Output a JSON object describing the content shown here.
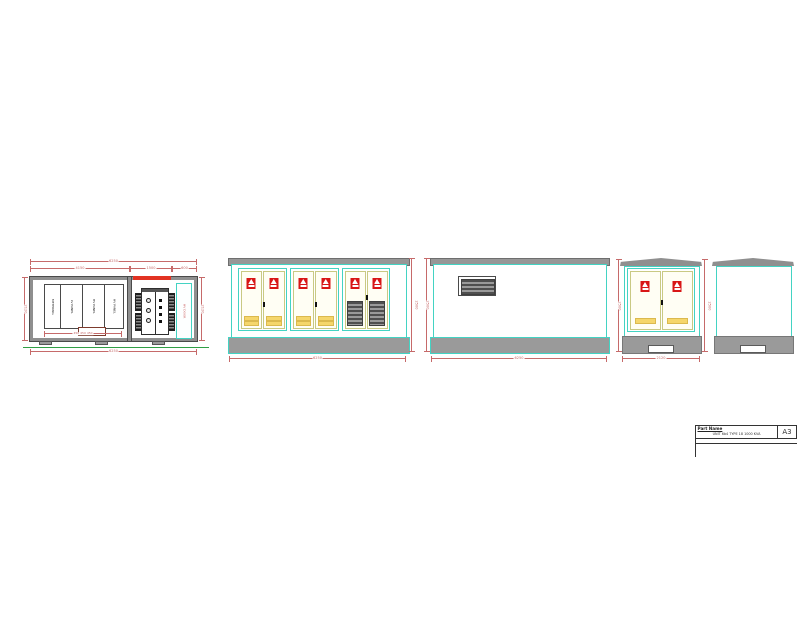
{
  "colors": {
    "cyan": "#43d3c3",
    "frame_gray": "#979797",
    "dim_red": "#c66a6a",
    "sign_red": "#d81616",
    "door_frame_yellow": "#c9c983",
    "vent_yellow": "#f5d66b",
    "centerline_green": "#2f9e44"
  },
  "title_block": {
    "header": "Part Name",
    "part_name": "UNIT 6b4 TYPE 18 1000 KVA",
    "sheet_size": "A3"
  },
  "plan_view": {
    "dims": {
      "total_top": "6250",
      "top_left": "4150",
      "top_mid": "1500",
      "top_right": "600",
      "left": "2120",
      "right": "2120",
      "bottom": "6250",
      "cells": "450  450  450"
    },
    "cells": [
      {
        "label": "METERING"
      },
      {
        "label": "LV PANEL"
      },
      {
        "label": "HV PANEL"
      },
      {
        "label": "HV PANEL"
      }
    ],
    "door_label": "HV DOOR"
  },
  "front_view": {
    "dims": {
      "height": "2500",
      "width": "6250"
    }
  },
  "rear_view": {
    "dims": {
      "height": "2500",
      "width": "6250"
    }
  },
  "side_view": {
    "dims": {
      "left": "2500",
      "right": "2500",
      "width": "2120"
    }
  }
}
